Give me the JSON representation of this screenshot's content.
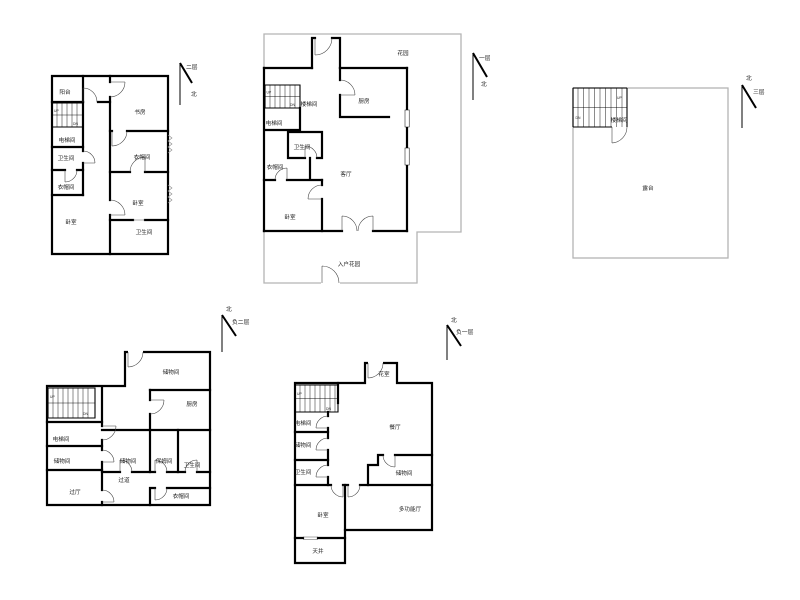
{
  "canvas": {
    "background": "#ffffff",
    "wall_color": "#000000",
    "boundary_color": "#b4b4b4"
  },
  "plans": [
    {
      "name": "second-floor",
      "compass": {
        "floor": "二层",
        "north": "北"
      },
      "stair": {
        "up": "UP",
        "dn": "DN"
      },
      "rooms": [
        {
          "label": "阳台"
        },
        {
          "label": "书房"
        },
        {
          "label": "电梯间"
        },
        {
          "label": "卫生间"
        },
        {
          "label": "衣帽间"
        },
        {
          "label": "卧室"
        },
        {
          "label": "衣帽间"
        },
        {
          "label": "卧室"
        },
        {
          "label": "卫生间"
        }
      ]
    },
    {
      "name": "first-floor",
      "compass": {
        "floor": "一层",
        "north": "北"
      },
      "stair": {
        "up": "UP",
        "dn": "DN"
      },
      "rooms": [
        {
          "label": "花园"
        },
        {
          "label": "厨房"
        },
        {
          "label": "楼梯间"
        },
        {
          "label": "电梯间"
        },
        {
          "label": "卫生间"
        },
        {
          "label": "衣帽间"
        },
        {
          "label": "客厅"
        },
        {
          "label": "卧室"
        },
        {
          "label": "入户花园"
        }
      ]
    },
    {
      "name": "third-floor",
      "compass": {
        "floor": "三层",
        "north": "北"
      },
      "stair": {
        "up": "UP",
        "dn": "DN"
      },
      "rooms": [
        {
          "label": "楼梯间"
        },
        {
          "label": "露台"
        }
      ]
    },
    {
      "name": "basement-two",
      "compass": {
        "floor": "负二层",
        "north": "北"
      },
      "stair": {
        "up": "UP",
        "dn": "DN"
      },
      "rooms": [
        {
          "label": "储物间"
        },
        {
          "label": "厨房"
        },
        {
          "label": "电梯间"
        },
        {
          "label": "储物间"
        },
        {
          "label": "储物间"
        },
        {
          "label": "保姆间"
        },
        {
          "label": "卫生间"
        },
        {
          "label": "过道"
        },
        {
          "label": "过厅"
        },
        {
          "label": "衣帽间"
        }
      ]
    },
    {
      "name": "basement-one",
      "compass": {
        "floor": "负一层",
        "north": "北"
      },
      "stair": {
        "up": "UP",
        "dn": "DN"
      },
      "rooms": [
        {
          "label": "花室"
        },
        {
          "label": "餐厅"
        },
        {
          "label": "电梯间"
        },
        {
          "label": "储物间"
        },
        {
          "label": "卫生间"
        },
        {
          "label": "储物间"
        },
        {
          "label": "多功能厅"
        },
        {
          "label": "卧室"
        },
        {
          "label": "天井"
        }
      ]
    }
  ]
}
